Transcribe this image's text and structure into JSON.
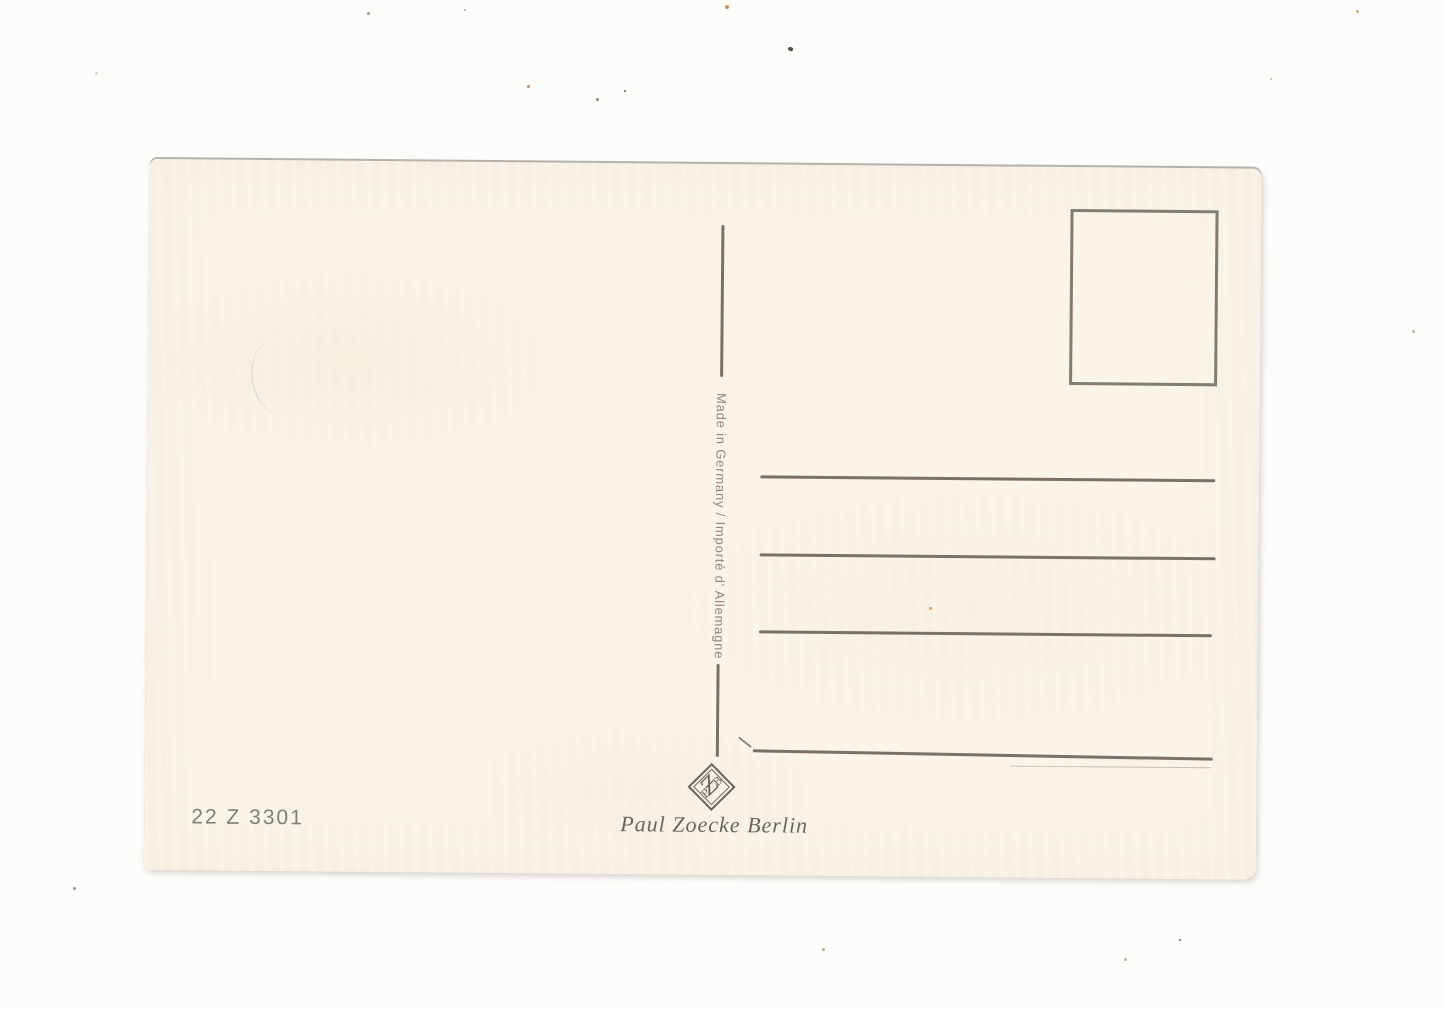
{
  "postcard": {
    "divider_text": "Made in Germany / Importé d' Allemagne",
    "order_number": "22 Z 3301",
    "publisher_name": "Paul Zoecke Berlin",
    "logo_letters": [
      "P",
      "Ƶ",
      "B"
    ],
    "address_line_count": 4
  },
  "colors": {
    "background": "#fcfcfa",
    "card": "#f9f3e8",
    "ink": "#6c6760",
    "ink_light": "#8e887b",
    "ink_text": "#6b665d",
    "order_ink": "#827e76"
  }
}
